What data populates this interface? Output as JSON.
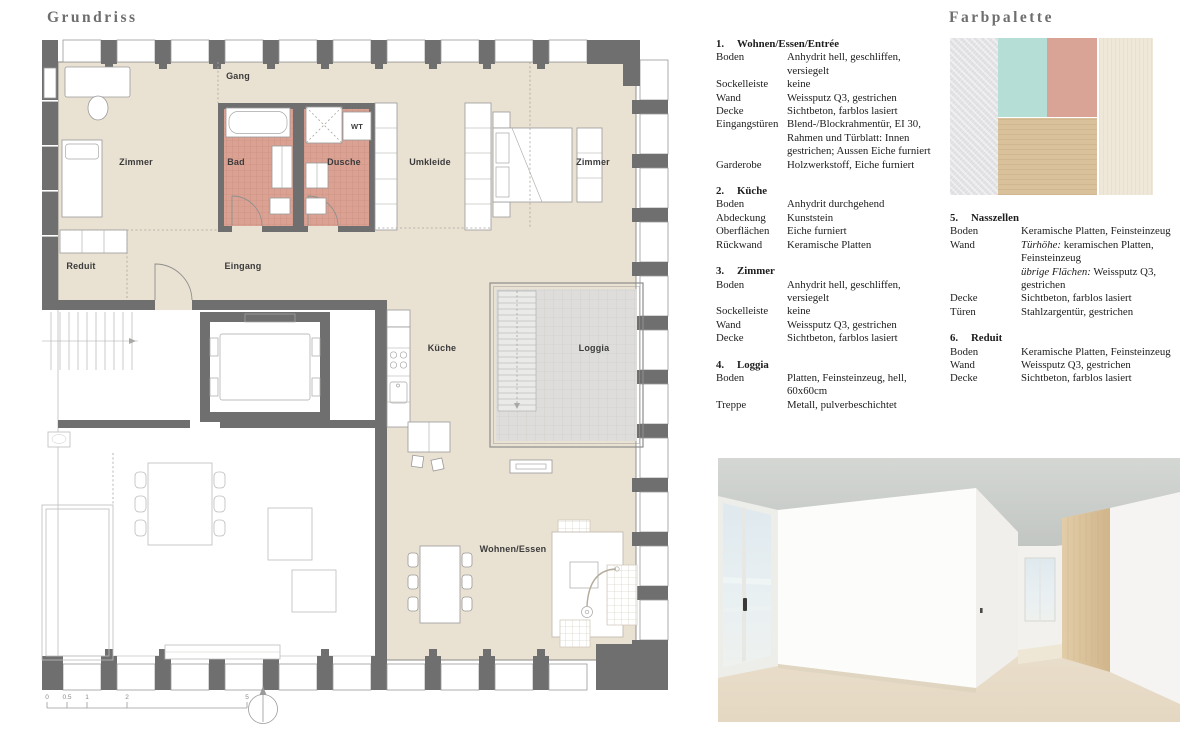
{
  "page": {
    "background": "#ffffff"
  },
  "plan": {
    "title": "Grundriss",
    "rooms": [
      {
        "id": "gang",
        "label": "Gang",
        "x": 198,
        "y": 41
      },
      {
        "id": "zimmer-west",
        "label": "Zimmer",
        "x": 96,
        "y": 127
      },
      {
        "id": "bad",
        "label": "Bad",
        "x": 196,
        "y": 127
      },
      {
        "id": "dusche",
        "label": "Dusche",
        "x": 304,
        "y": 127
      },
      {
        "id": "wt",
        "label": "WT",
        "x": 317,
        "y": 91,
        "small": true
      },
      {
        "id": "umkleide",
        "label": "Umkleide",
        "x": 390,
        "y": 127
      },
      {
        "id": "zimmer-ost",
        "label": "Zimmer",
        "x": 553,
        "y": 127
      },
      {
        "id": "reduit",
        "label": "Reduit",
        "x": 41,
        "y": 231
      },
      {
        "id": "eingang",
        "label": "Eingang",
        "x": 203,
        "y": 231
      },
      {
        "id": "kueche",
        "label": "Küche",
        "x": 402,
        "y": 313
      },
      {
        "id": "loggia",
        "label": "Loggia",
        "x": 554,
        "y": 313
      },
      {
        "id": "wohnen-essen",
        "label": "Wohnen/Essen",
        "x": 473,
        "y": 514
      }
    ],
    "scalebar": {
      "ticks": [
        {
          "label": "0",
          "x": 7
        },
        {
          "label": "0.5",
          "x": 27
        },
        {
          "label": "1",
          "x": 47
        },
        {
          "label": "2",
          "x": 87
        },
        {
          "label": "5",
          "x": 207
        }
      ]
    },
    "colors": {
      "floor": "#e9e1d2",
      "wall": "#6f6f6f",
      "wet_tile": "#dba294",
      "loggia_tile": "#dedddb"
    }
  },
  "specs": {
    "columns": [
      {
        "sections": [
          {
            "num": "1.",
            "title": "Wohnen/Essen/Entrée",
            "rows": [
              {
                "label": "Boden",
                "value": "Anhydrit hell, geschliffen, versiegelt"
              },
              {
                "label": "Sockelleiste",
                "value": "keine"
              },
              {
                "label": "Wand",
                "value": "Weissputz Q3, gestrichen"
              },
              {
                "label": "Decke",
                "value": "Sichtbeton, farblos lasiert"
              },
              {
                "label": "Eingangstüren",
                "value": "Blend-/Blockrahmentür, EI 30, Rahmen und Türblatt: Innen gestrichen; Aussen Eiche furniert"
              },
              {
                "label": "Garderobe",
                "value": "Holzwerkstoff, Eiche furniert"
              }
            ]
          },
          {
            "num": "2.",
            "title": "Küche",
            "rows": [
              {
                "label": "Boden",
                "value": "Anhydrit durchgehend"
              },
              {
                "label": "Abdeckung",
                "value": "Kunststein"
              },
              {
                "label": "Oberflächen",
                "value": "Eiche furniert"
              },
              {
                "label": "Rückwand",
                "value": "Keramische Platten"
              }
            ]
          },
          {
            "num": "3.",
            "title": "Zimmer",
            "rows": [
              {
                "label": "Boden",
                "value": "Anhydrit hell, geschliffen, versiegelt"
              },
              {
                "label": "Sockelleiste",
                "value": "keine"
              },
              {
                "label": "Wand",
                "value": "Weissputz Q3, gestrichen"
              },
              {
                "label": "Decke",
                "value": "Sichtbeton, farblos lasiert"
              }
            ]
          },
          {
            "num": "4.",
            "title": "Loggia",
            "rows": [
              {
                "label": "Boden",
                "value": "Platten, Feinsteinzeug, hell, 60x60cm"
              },
              {
                "label": "Treppe",
                "value": "Metall, pulverbeschichtet"
              }
            ]
          }
        ]
      },
      {
        "sections": [
          {
            "num": "5.",
            "title": "Nasszellen",
            "rows": [
              {
                "label": "Boden",
                "value": "Keramische Platten, Feinsteinzeug"
              },
              {
                "label": "Wand",
                "value": "Türhöhe: keramischen Platten, Feinsteinzeug\nübrige Flächen: Weissputz Q3, gestrichen",
                "italics": [
                  "Türhöhe:",
                  "übrige Flächen:"
                ]
              },
              {
                "label": "Decke",
                "value": "Sichtbeton, farblos lasiert"
              },
              {
                "label": "Türen",
                "value": "Stahlzargentür, gestrichen"
              }
            ]
          },
          {
            "num": "6.",
            "title": "Reduit",
            "rows": [
              {
                "label": "Boden",
                "value": "Keramische Platten, Feinsteinzeug"
              },
              {
                "label": "Wand",
                "value": "Weissputz Q3, gestrichen"
              },
              {
                "label": "Decke",
                "value": "Sichtbeton, farblos lasiert"
              }
            ]
          }
        ]
      }
    ]
  },
  "palette": {
    "title": "Farbpalette",
    "swatches": [
      {
        "name": "concrete-gray",
        "color": "#e4e3e6"
      },
      {
        "name": "mint-green",
        "color": "#b5ded7"
      },
      {
        "name": "salmon-red",
        "color": "#d9a396"
      },
      {
        "name": "oak-wood",
        "color": "#d8c19b"
      },
      {
        "name": "cream-stone",
        "color": "#efe8d9"
      }
    ]
  }
}
